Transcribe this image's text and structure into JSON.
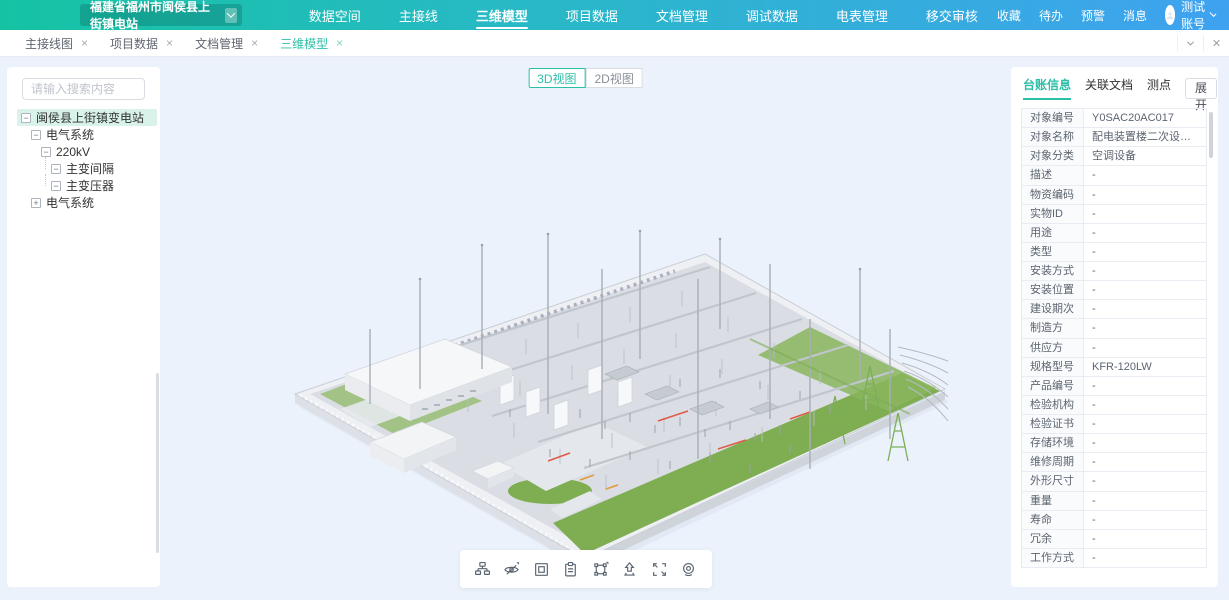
{
  "navbar": {
    "station_selector": {
      "label": "福建省福州市闽侯县上街镇电站"
    },
    "menu": [
      {
        "label": "数据空间"
      },
      {
        "label": "主接线"
      },
      {
        "label": "三维模型",
        "active": true
      },
      {
        "label": "项目数据"
      },
      {
        "label": "文档管理"
      },
      {
        "label": "调试数据"
      },
      {
        "label": "电表管理"
      },
      {
        "label": "移交审核"
      }
    ],
    "quick_links": [
      {
        "label": "收藏"
      },
      {
        "label": "待办"
      },
      {
        "label": "预警"
      },
      {
        "label": "消息"
      }
    ],
    "user": {
      "name": "测试账号"
    }
  },
  "tabbar": {
    "tabs": [
      {
        "label": "主接线图"
      },
      {
        "label": "项目数据"
      },
      {
        "label": "文档管理"
      },
      {
        "label": "三维模型",
        "active": true
      }
    ],
    "close_glyph": "×"
  },
  "sidebar": {
    "search_placeholder": "请输入搜索内容",
    "tree": [
      {
        "label": "闽侯县上街镇变电站",
        "level": 0,
        "expanded": true,
        "selected": true
      },
      {
        "label": "电气系统",
        "level": 1,
        "expanded": true
      },
      {
        "label": "220kV",
        "level": 2,
        "expanded": true
      },
      {
        "label": "主变间隔",
        "level": 3,
        "expanded": true,
        "connector": true
      },
      {
        "label": "主变压器",
        "level": 3,
        "expanded": true,
        "connector": true
      },
      {
        "label": "电气系统",
        "level": 1,
        "expanded": false
      }
    ]
  },
  "viewport": {
    "view_modes": [
      {
        "label": "3D视图",
        "active": true
      },
      {
        "label": "2D视图"
      }
    ],
    "toolbar_icons": [
      "hierarchy-icon",
      "visibility-off-icon",
      "region-select-icon",
      "document-icon",
      "transform-icon",
      "move-up-icon",
      "fullscreen-icon",
      "camera-icon"
    ]
  },
  "panel": {
    "tabs": [
      {
        "label": "台账信息",
        "active": true
      },
      {
        "label": "关联文档"
      },
      {
        "label": "测点"
      }
    ],
    "expand_button": "展开",
    "rows": [
      {
        "label": "对象编号",
        "value": "Y0SAC20AC017"
      },
      {
        "label": "对象名称",
        "value": "配电装置楼二次设备室柜式空..."
      },
      {
        "label": "对象分类",
        "value": "空调设备"
      },
      {
        "label": "描述",
        "value": "-"
      },
      {
        "label": "物资编码",
        "value": "-"
      },
      {
        "label": "实物ID",
        "value": "-"
      },
      {
        "label": "用途",
        "value": "-"
      },
      {
        "label": "类型",
        "value": "-"
      },
      {
        "label": "安装方式",
        "value": "-"
      },
      {
        "label": "安装位置",
        "value": "-"
      },
      {
        "label": "建设期次",
        "value": "-"
      },
      {
        "label": "制造方",
        "value": "-"
      },
      {
        "label": "供应方",
        "value": "-"
      },
      {
        "label": "规格型号",
        "value": "KFR-120LW"
      },
      {
        "label": "产品编号",
        "value": "-"
      },
      {
        "label": "检验机构",
        "value": "-"
      },
      {
        "label": "检验证书",
        "value": "-"
      },
      {
        "label": "存储环境",
        "value": "-"
      },
      {
        "label": "维修周期",
        "value": "-"
      },
      {
        "label": "外形尺寸",
        "value": "-"
      },
      {
        "label": "重量",
        "value": "-"
      },
      {
        "label": "寿命",
        "value": "-"
      },
      {
        "label": "冗余",
        "value": "-"
      },
      {
        "label": "工作方式",
        "value": "-"
      }
    ]
  },
  "colors": {
    "accent": "#2cbfa7",
    "navbar_gradient_start": "#15c3a3",
    "navbar_gradient_end": "#3fa2f0",
    "tree_selected_bg": "#d9f2ea"
  }
}
